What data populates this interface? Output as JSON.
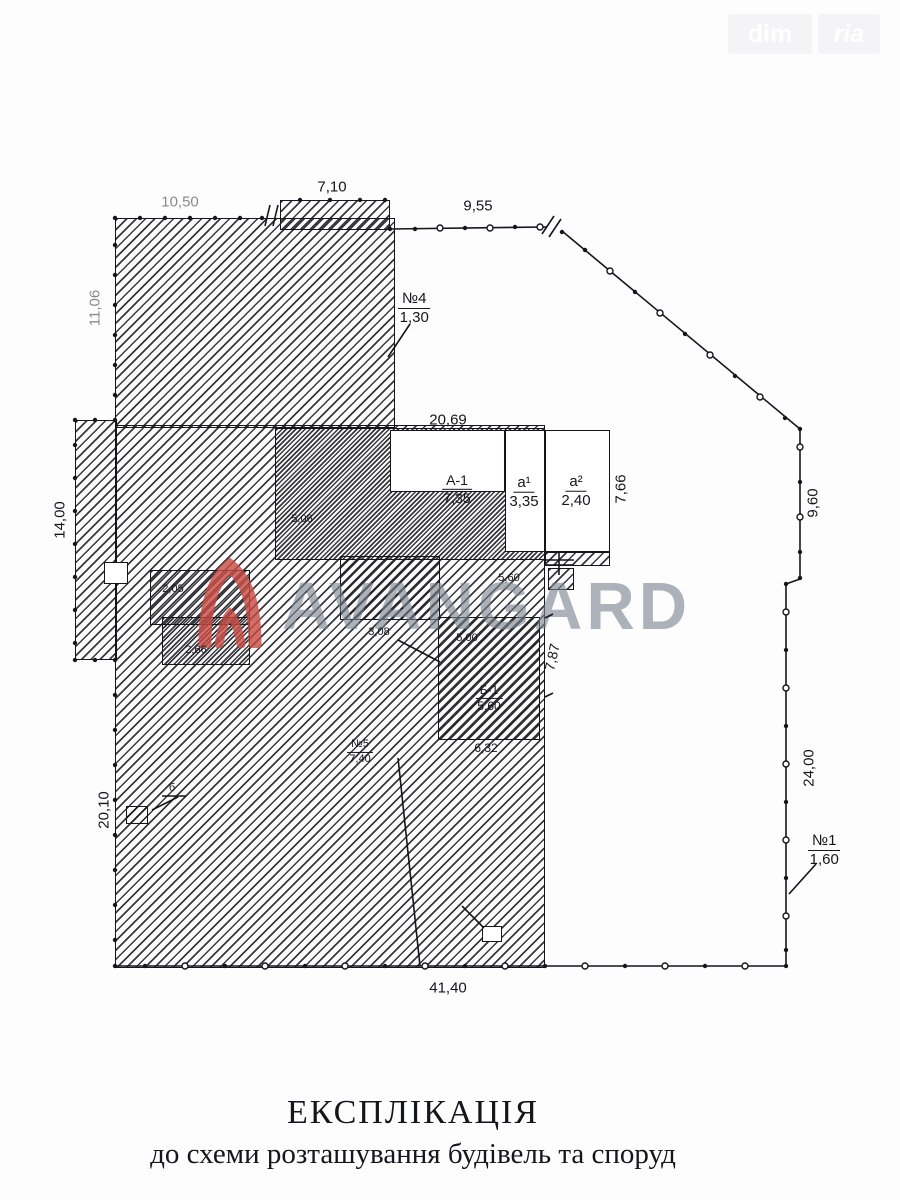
{
  "corner_logo": {
    "left": "dim",
    "right": "ria"
  },
  "watermark": {
    "text": "AVANGARD"
  },
  "caption": {
    "title": "ЕКСПЛІКАЦІЯ",
    "subtitle": "до схеми розташування будівель та споруд"
  },
  "dims": {
    "top_left": "10,50",
    "top_step": "7,10",
    "top_right": "9,55",
    "left_upper": "11,06",
    "left_wing": "14,00",
    "left_lower": "20,10",
    "right_upper": "9,60",
    "right_lower": "24,00",
    "bottom": "41,40",
    "bld_width": "20,69",
    "bld_depth": "7,66",
    "inner_right": "7,87",
    "b1_bottom": "6,32",
    "room_1": "5,06",
    "room_2": "3,08",
    "room_3": "5,00",
    "room_4": "5,60",
    "shed_1": "2,05",
    "shed_2": "2,66"
  },
  "marks": {
    "no4": {
      "label": "№4",
      "value": "1,30"
    },
    "no1": {
      "label": "№1",
      "value": "1,60"
    },
    "no5": {
      "label": "№5",
      "value": "7,40"
    },
    "a1": {
      "label": "А-1",
      "value": "7,35"
    },
    "a_sup1": {
      "label": "а¹",
      "value": "3,35"
    },
    "a_sup2": {
      "label": "а²",
      "value": "2,40"
    },
    "b1": {
      "label": "Б-1",
      "value": "5,60"
    },
    "small_b": "б"
  }
}
